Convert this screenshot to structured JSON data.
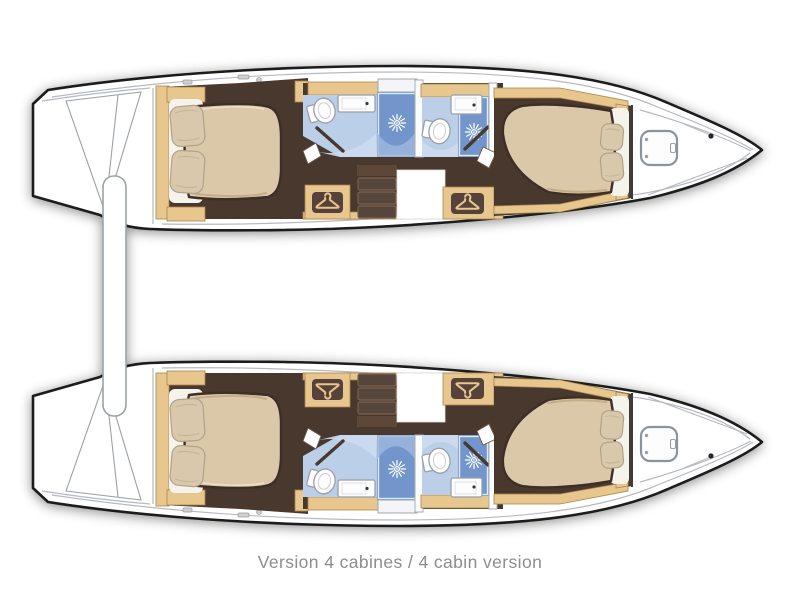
{
  "caption": "Version 4 cabines / 4 cabin version",
  "plan": {
    "type": "catamaran-interior-floor-plan",
    "hulls": [
      {
        "name": "top hull",
        "rooms": [
          {
            "label": "aft double cabin",
            "fixtures": [
              "island-berth",
              "pillow",
              "pillow",
              "hanging-locker"
            ]
          },
          {
            "label": "aft bathroom",
            "fixtures": [
              "toilet",
              "washbasin",
              "shower"
            ]
          },
          {
            "label": "companionway",
            "fixtures": [
              "steps"
            ]
          },
          {
            "label": "forward bathroom",
            "fixtures": [
              "toilet",
              "washbasin",
              "shower"
            ]
          },
          {
            "label": "forward double cabin",
            "fixtures": [
              "island-berth",
              "pillow",
              "pillow",
              "hanging-locker"
            ]
          },
          {
            "label": "forepeak",
            "fixtures": [
              "deck-hatch"
            ]
          }
        ]
      },
      {
        "name": "bottom hull",
        "rooms": [
          {
            "label": "aft double cabin",
            "fixtures": [
              "island-berth",
              "pillow",
              "pillow",
              "hanging-locker"
            ]
          },
          {
            "label": "aft bathroom",
            "fixtures": [
              "toilet",
              "washbasin",
              "shower"
            ]
          },
          {
            "label": "companionway",
            "fixtures": [
              "steps"
            ]
          },
          {
            "label": "forward bathroom",
            "fixtures": [
              "toilet",
              "washbasin",
              "shower"
            ]
          },
          {
            "label": "forward double cabin",
            "fixtures": [
              "island-berth",
              "pillow",
              "pillow",
              "hanging-locker"
            ]
          },
          {
            "label": "forepeak",
            "fixtures": [
              "deck-hatch"
            ]
          }
        ]
      }
    ],
    "fixture_totals": {
      "cabins": 4,
      "toilets": 4,
      "showers": 4,
      "washbasins": 4,
      "hanging_lockers": 4,
      "deck_hatches": 2,
      "step_flights": 2
    }
  },
  "icons": [
    "shower-head-icon",
    "hanger-icon",
    "toilet-icon",
    "sink-icon",
    "hatch-icon"
  ],
  "colors": {
    "outline": "#1b1b1b",
    "deck_line": "#b6bac0",
    "wood": "#e8c78f",
    "wood_edge": "#a9834a",
    "floor_dark": "#4a372f",
    "step_face": "#57443a",
    "step_edge": "#7a644f",
    "plaque": "#57433a",
    "mattress": "#dbc8a8",
    "mattress_edge": "#3e2e27",
    "mattress_shade": "#c4ad89",
    "pillow": "#d9c8ac",
    "pillow_edge": "#b1a28a",
    "sheet": "#f6f3ec",
    "bath_floor": "#bccfe9",
    "bath_light": "#ccdaee",
    "shower_blue": "#7296cb",
    "fixture_white": "#fdfdfd",
    "fixture_edge": "#98a0a9",
    "hatch_edge": "#8d939a",
    "caption_gray": "#8b8d90"
  }
}
